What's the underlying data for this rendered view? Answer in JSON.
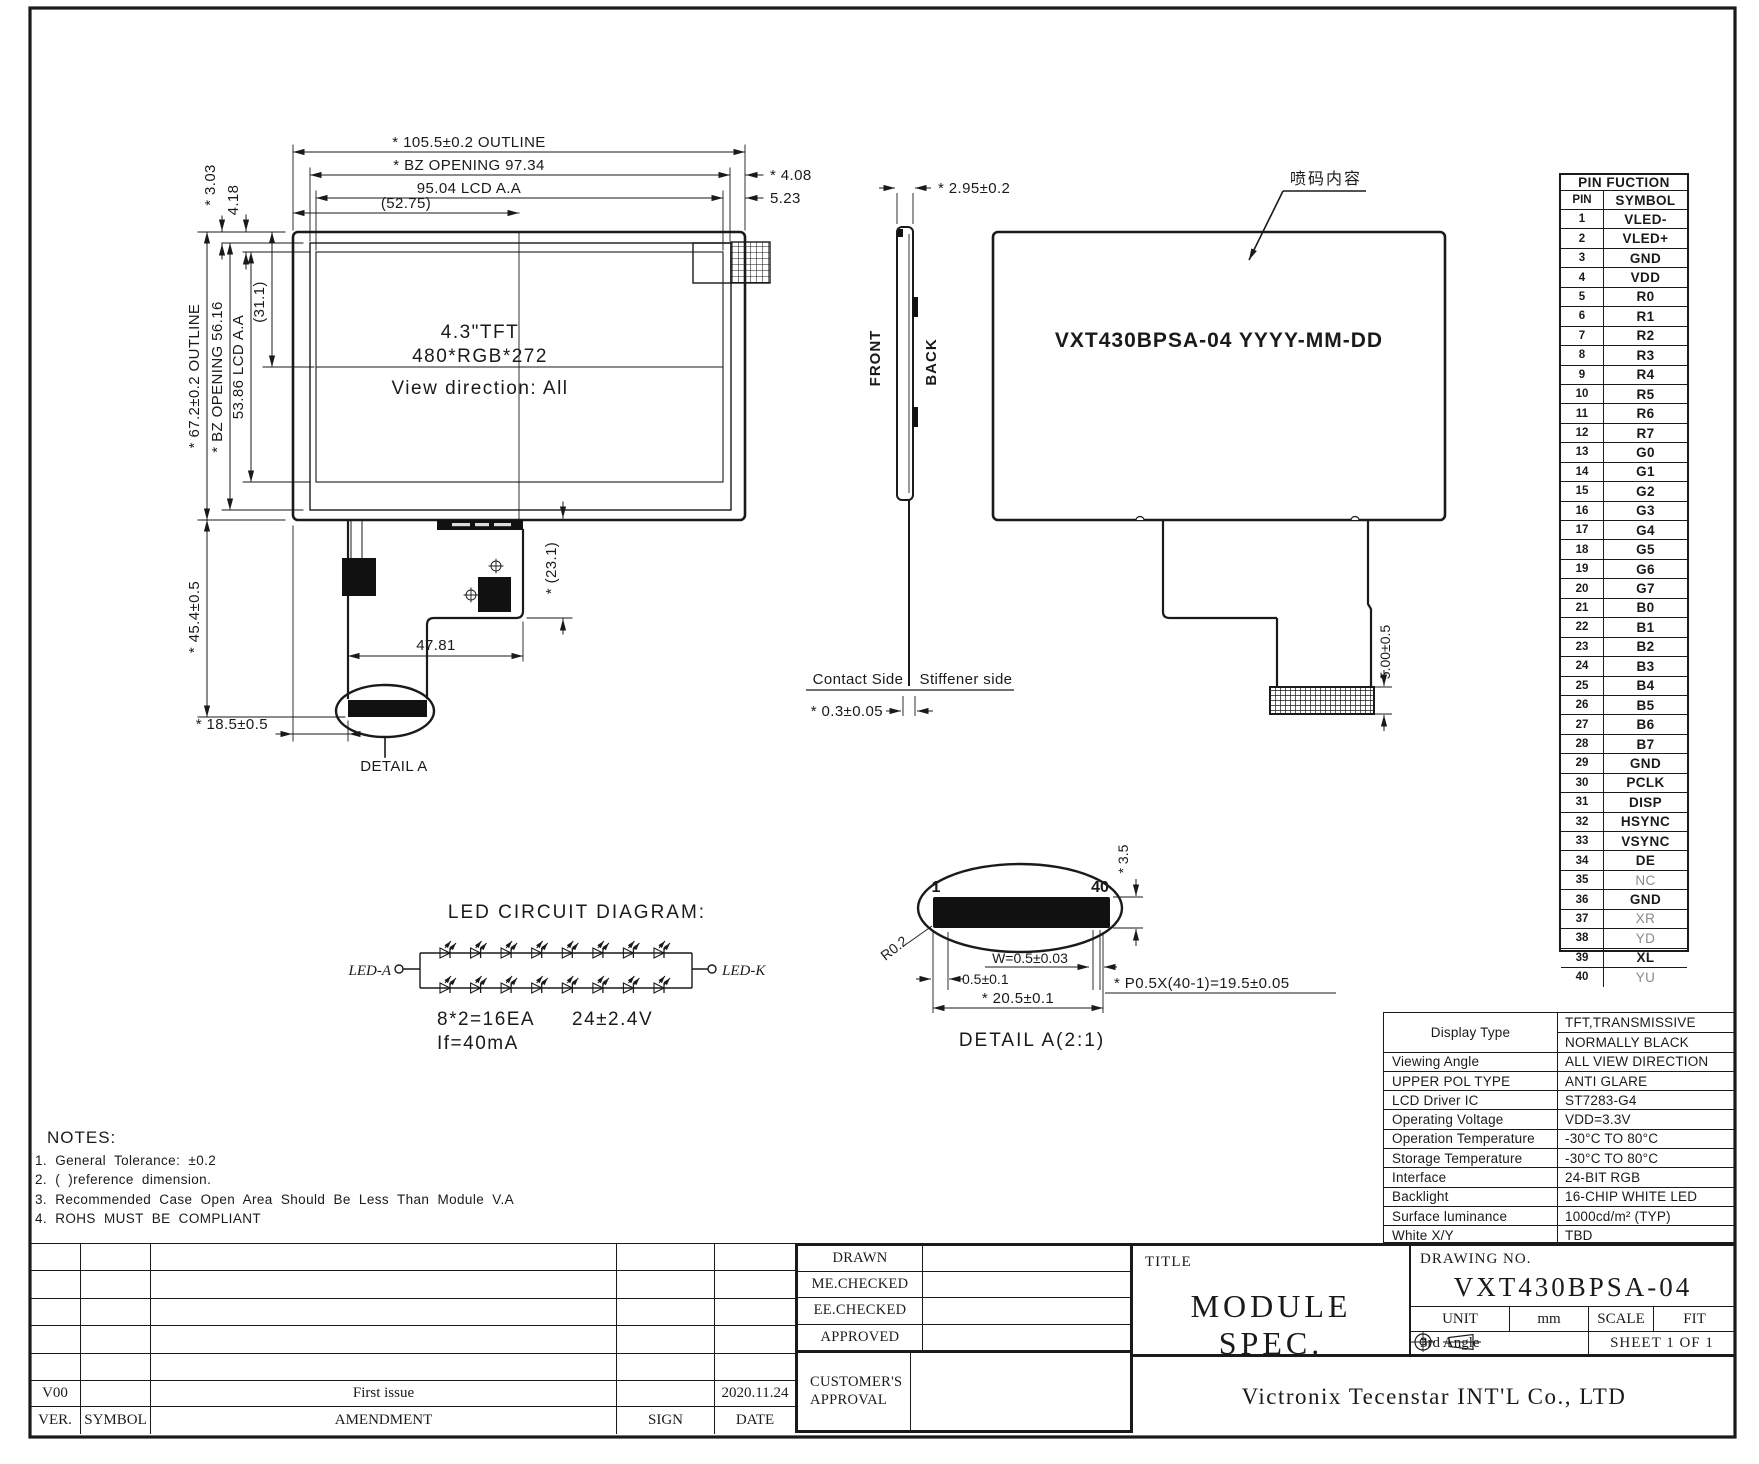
{
  "colors": {
    "ink": "#1a1a1a",
    "paper": "#ffffff"
  },
  "fv": {
    "dim_outline_h": "* 105.5±0.2 OUTLINE",
    "dim_bz_h": "* BZ OPENING 97.34",
    "dim_aa_h": "95.04 LCD A.A",
    "dim_center_h": "(52.75)",
    "dim_right_1": "* 4.08",
    "dim_right_2": "5.23",
    "dim_left_1": "* 3.03",
    "dim_left_2": "4.18",
    "dim_outline_v": "* 67.2±0.2 OUTLINE",
    "dim_bz_v": "* BZ OPENING 56.16",
    "dim_aa_v": "53.86 LCD A.A",
    "dim_center_v": "(31.1)",
    "size_label": "4.3\"TFT",
    "resolution_label": "480*RGB*272",
    "view_direction_label": "View direction: All",
    "dim_fpc_height": "* (23.1)",
    "dim_fpc_width": "47.81",
    "dim_fpc_length": "* 45.4±0.5",
    "dim_fpc_offset": "* 18.5±0.5",
    "detail_label": "DETAIL A"
  },
  "sv": {
    "dim_thickness": "* 2.95±0.2",
    "front_label": "FRONT",
    "back_label": "BACK",
    "contact_label": "Contact Side",
    "stiffener_label": "Stiffener side",
    "dim_fpc_thickness": "* 0.3±0.05"
  },
  "bv": {
    "marking_text": "VXT430BPSA-04 YYYY-MM-DD",
    "marking_callout": "喷码内容",
    "dim_connector": "5.00±0.5"
  },
  "led": {
    "title": "LED CIRCUIT DIAGRAM:",
    "anode_label": "LED-A",
    "cathode_label": "LED-K",
    "spec_quantity": "8*2=16EA",
    "spec_voltage": "24±2.4V",
    "spec_current": "If=40mA"
  },
  "da": {
    "pin_first": "1",
    "pin_last": "40",
    "dim_height": "* 3.5",
    "radius_label": "R0.2",
    "dim_w": "W=0.5±0.03",
    "dim_pad": "0.5±0.1",
    "dim_total": "* 20.5±0.1",
    "dim_pitch": "* P0.5X(40-1)=19.5±0.05",
    "title": "DETAIL A(2:1)"
  },
  "pins": {
    "title": "PIN FUCTION",
    "col_pin": "PIN",
    "col_symbol": "SYMBOL",
    "list": [
      {
        "no": "1",
        "symbol": "VLED-"
      },
      {
        "no": "2",
        "symbol": "VLED+"
      },
      {
        "no": "3",
        "symbol": "GND"
      },
      {
        "no": "4",
        "symbol": "VDD"
      },
      {
        "no": "5",
        "symbol": "R0"
      },
      {
        "no": "6",
        "symbol": "R1"
      },
      {
        "no": "7",
        "symbol": "R2"
      },
      {
        "no": "8",
        "symbol": "R3"
      },
      {
        "no": "9",
        "symbol": "R4"
      },
      {
        "no": "10",
        "symbol": "R5"
      },
      {
        "no": "11",
        "symbol": "R6"
      },
      {
        "no": "12",
        "symbol": "R7"
      },
      {
        "no": "13",
        "symbol": "G0"
      },
      {
        "no": "14",
        "symbol": "G1"
      },
      {
        "no": "15",
        "symbol": "G2"
      },
      {
        "no": "16",
        "symbol": "G3"
      },
      {
        "no": "17",
        "symbol": "G4"
      },
      {
        "no": "18",
        "symbol": "G5"
      },
      {
        "no": "19",
        "symbol": "G6"
      },
      {
        "no": "20",
        "symbol": "G7"
      },
      {
        "no": "21",
        "symbol": "B0"
      },
      {
        "no": "22",
        "symbol": "B1"
      },
      {
        "no": "23",
        "symbol": "B2"
      },
      {
        "no": "24",
        "symbol": "B3"
      },
      {
        "no": "25",
        "symbol": "B4"
      },
      {
        "no": "26",
        "symbol": "B5"
      },
      {
        "no": "27",
        "symbol": "B6"
      },
      {
        "no": "28",
        "symbol": "B7"
      },
      {
        "no": "29",
        "symbol": "GND"
      },
      {
        "no": "30",
        "symbol": "PCLK"
      },
      {
        "no": "31",
        "symbol": "DISP"
      },
      {
        "no": "32",
        "symbol": "HSYNC"
      },
      {
        "no": "33",
        "symbol": "VSYNC"
      },
      {
        "no": "34",
        "symbol": "DE"
      },
      {
        "no": "35",
        "symbol": "NC",
        "light": true
      },
      {
        "no": "36",
        "symbol": "GND"
      },
      {
        "no": "37",
        "symbol": "XR",
        "light": true
      },
      {
        "no": "38",
        "symbol": "YD",
        "light": true
      },
      {
        "no": "39",
        "symbol": "XL"
      },
      {
        "no": "40",
        "symbol": "YU",
        "light": true
      }
    ]
  },
  "spec": {
    "rows": [
      {
        "label": "Display Type",
        "values": [
          "TFT,TRANSMISSIVE",
          "NORMALLY BLACK"
        ]
      },
      {
        "label": "Viewing Angle",
        "values": [
          "ALL VIEW DIRECTION"
        ]
      },
      {
        "label": "UPPER POL TYPE",
        "values": [
          "ANTI GLARE"
        ]
      },
      {
        "label": "LCD Driver IC",
        "values": [
          "ST7283-G4"
        ]
      },
      {
        "label": "Operating Voltage",
        "values": [
          "VDD=3.3V"
        ]
      },
      {
        "label": "Operation Temperature",
        "values": [
          "-30°C TO 80°C"
        ]
      },
      {
        "label": "Storage Temperature",
        "values": [
          "-30°C TO 80°C"
        ]
      },
      {
        "label": "Interface",
        "values": [
          "24-BIT RGB"
        ]
      },
      {
        "label": "Backlight",
        "values": [
          "16-CHIP WHITE LED"
        ]
      },
      {
        "label": "Surface luminance",
        "values": [
          "1000cd/m² (TYP)"
        ]
      },
      {
        "label": "White X/Y",
        "values": [
          "TBD"
        ]
      }
    ]
  },
  "notes": {
    "title": "NOTES:",
    "items": [
      "1. General Tolerance: ±0.2",
      "2. (    )reference dimension.",
      "3. Recommended Case Open Area Should Be Less Than Module V.A",
      "4. ROHS   MUST BE COMPLIANT"
    ]
  },
  "tb": {
    "rev_header": {
      "ver": "VER.",
      "symbol": "SYMBOL",
      "amendment": "AMENDMENT",
      "sign": "SIGN",
      "date": "DATE"
    },
    "revisions": [
      {
        "ver": "V00",
        "symbol": "",
        "amendment": "First issue",
        "sign": "",
        "date": "2020.11.24"
      }
    ],
    "approval_labels": [
      "DRAWN",
      "ME.CHECKED",
      "EE.CHECKED",
      "APPROVED"
    ],
    "customer_approval": "CUSTOMER'S APPROVAL",
    "title_label": "TITLE",
    "title": "MODULE SPEC.",
    "drawing_no_label": "DRAWING NO.",
    "drawing_no": "VXT430BPSA-04",
    "unit_label": "UNIT",
    "unit_value": "mm",
    "scale_label": "SCALE",
    "fit_value": "FIT",
    "angle_label": "3rd Angle",
    "sheet_label": "SHEET 1 OF 1",
    "company": "Victronix Tecenstar INT'L Co., LTD"
  }
}
